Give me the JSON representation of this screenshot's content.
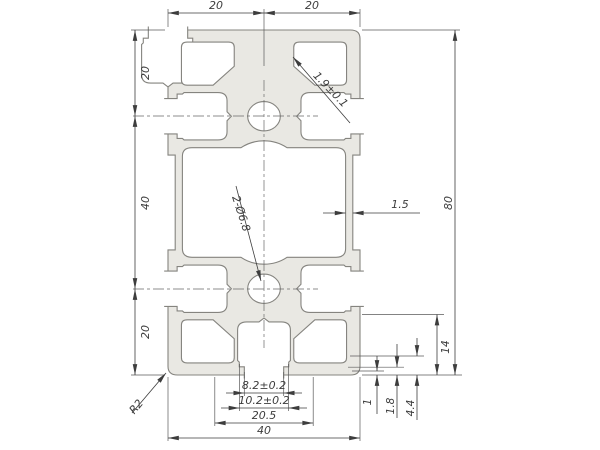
{
  "drawing": {
    "type": "cad-cross-section",
    "subject": "aluminium-extrusion-profile-40x80",
    "colors": {
      "profile_fill": "#e9e8e3",
      "profile_stroke": "#85847f",
      "dimension_color": "#3d3d3d",
      "background": "#ffffff"
    },
    "dims": {
      "top": [
        "20",
        "20"
      ],
      "left": [
        "20",
        "40",
        "20"
      ],
      "right": "80",
      "wall_thickness": "1.5",
      "web_thickness": "1.9±0.1",
      "holes_callout": "2-Ø6.8",
      "corner_radius": "R2",
      "bottom": [
        "8.2±0.2",
        "10.2±0.2",
        "20.5",
        "40"
      ],
      "detail_right": [
        "1",
        "1.8",
        "4.4",
        "14"
      ]
    }
  }
}
